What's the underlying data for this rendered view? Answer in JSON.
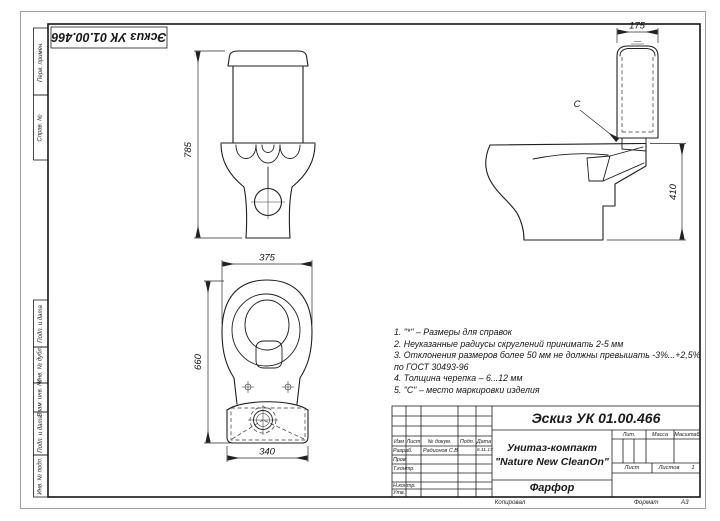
{
  "corner_stamp": {
    "designation": "Эскиз УК 01.00.466"
  },
  "frame_strips": [
    {
      "label": "Перв. примен."
    },
    {
      "label": "Справ. №"
    },
    {
      "label": "Подп. и дата"
    },
    {
      "label": "Инв. № дубл."
    },
    {
      "label": "Взам. инв. №"
    },
    {
      "label": "Подп. и дата"
    },
    {
      "label": "Инв. № подл."
    }
  ],
  "dims": {
    "front_height": "785",
    "top_width": "375",
    "top_length": "660",
    "tank_footprint_width": "340",
    "tank_side_width": "175",
    "bowl_height": "410",
    "marking_label": "C"
  },
  "notes": {
    "lines": [
      "1. \"*\" – Размеры для справок",
      "2. Неуказанные радиусы скруглений принимать 2-5 мм",
      "3. Отклонения размеров более 50 мм не должны превышать -3%...+2,5%",
      "по ГОСТ 30493-96",
      "4. Толщина черепка – 6...12 мм",
      "5. \"С\" – место маркировки изделия"
    ]
  },
  "title_block": {
    "designation": "Эскиз УК 01.00.466",
    "product_line1": "Унитаз-компакт",
    "product_line2": "\"Nature New CleanOn\"",
    "material": "Фарфор",
    "header": {
      "izm": "Изм",
      "list": "Лист",
      "doc": "№ докум.",
      "podp": "Подп.",
      "data": "Дата"
    },
    "signature_rows": [
      {
        "label": "Разраб.",
        "name": "Радионов С.В",
        "date": "6.11.17"
      },
      {
        "label": "Пров.",
        "name": "",
        "date": ""
      },
      {
        "label": "Т.контр.",
        "name": "",
        "date": ""
      },
      {
        "label": "Н.контр.",
        "name": "",
        "date": ""
      },
      {
        "label": "Утв.",
        "name": "",
        "date": ""
      }
    ],
    "lit_label": "Лит.",
    "mass_label": "Масса",
    "scale_label": "Масштаб",
    "sheet_label": "Лист",
    "sheets_label": "Листов",
    "sheets_value": "1",
    "copied_label": "Копировал",
    "format_label": "Формат",
    "format_value": "А3"
  }
}
